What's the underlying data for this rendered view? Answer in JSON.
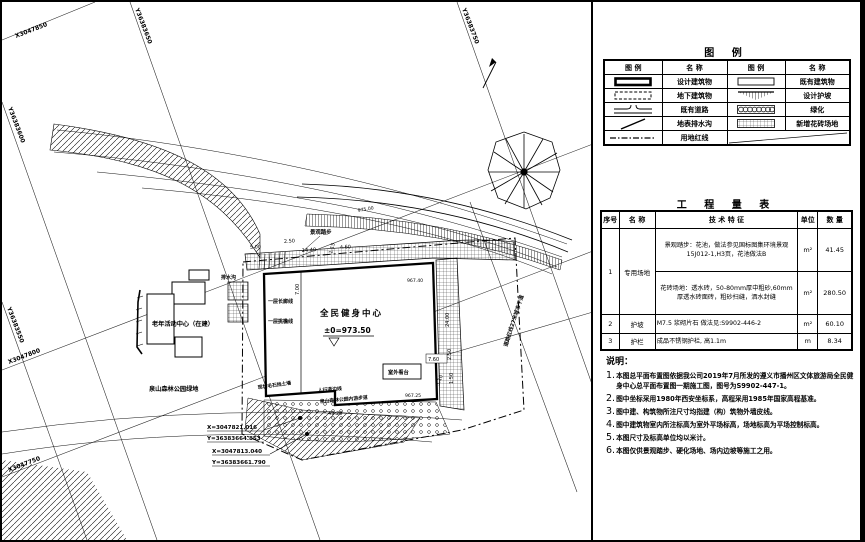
{
  "legend": {
    "title": "图  例",
    "headers": [
      "图  例",
      "名  称",
      "图  例",
      "名  称"
    ],
    "names": {
      "design_building": "设计建筑物",
      "existing_building": "既有建筑物",
      "underground_building": "地下建筑物",
      "design_slope": "设计护坡",
      "existing_road": "既有道路",
      "greenery": "绿化",
      "surface_ditch": "地表排水沟",
      "new_tile_ground": "新增花砖场地",
      "land_red_line": "用地红线"
    }
  },
  "quantity": {
    "title": "工 程 量 表",
    "headers": [
      "序号",
      "名  称",
      "技  术  特  征",
      "单位",
      "数  量"
    ],
    "rows": {
      "r1_no": "1",
      "r1_name": "专用场地",
      "r1a_tech": "景观踏步：花池，做法参见国标图集环境景观 15J012-1,H3页，花池做法B",
      "r1a_unit": "m²",
      "r1a_qty": "41.45",
      "r1b_tech": "花砖场地：透水砖，50-80mm厚中粗砂,60mm 厚透水砖面砖，粗砂扫缝，洒水封缝",
      "r1b_unit": "m²",
      "r1b_qty": "280.50",
      "r2_no": "2",
      "r2_name": "护坡",
      "r2_tech": "M7.5 浆砌片石  做法见:S9902-446-2",
      "r2_unit": "m²",
      "r2_qty": "60.10",
      "r3_no": "3",
      "r3_name": "护栏",
      "r3_tech": "成品不锈钢护栏, 高1.1m",
      "r3_unit": "m",
      "r3_qty": "8.34"
    }
  },
  "notes": {
    "title": "说明：",
    "items": [
      {
        "no": "1.",
        "text": "本图总平面布置图依据我公司2019年7月所发的遵义市播州区文体旅游局全民健身中心总平面布置图一期施工图，图号为S9902-447-1。"
      },
      {
        "no": "2.",
        "text": "图中坐标采用1980年西安坐标系，高程采用1985年国家高程基准。"
      },
      {
        "no": "3.",
        "text": "图中建、构筑物所注尺寸均指建（构）筑物外墙皮线。"
      },
      {
        "no": "4.",
        "text": "图中建筑物室内所注标高为室外平场标高，场地标高为平场控制标高。"
      },
      {
        "no": "5.",
        "text": "本图尺寸及标高单位均以米计。"
      },
      {
        "no": "6.",
        "text": "本图仅供景观踏步、硬化场地、场内边坡等施工之用。"
      }
    ]
  },
  "plan": {
    "building_name": "全民健身中心",
    "building_level": "±0=973.50",
    "senior_center": "老年活动中心（在建）",
    "park_green": "泉山森林公园绿地",
    "park_path": "泉山森林公园内游步道",
    "sidewalk": "人行道边线",
    "retaining_wall": "现状毛石挡土墙",
    "landscape_steps": "景观踏步",
    "corridor_line": "一层长廊线",
    "eave_line": "一层挑檐线",
    "drain": "排水沟",
    "outdoor_stand": "室外看台",
    "road_label": "道路红线27米城市干道",
    "grid": {
      "x1": "X3047850",
      "x2": "X3047800",
      "x3": "X3047750",
      "y1": "Y36383600",
      "y2": "Y36383550",
      "y3": "Y36383650",
      "y4": "Y36383750"
    },
    "coords": {
      "p1x": "X=3047821.016",
      "p1y": "Y=36383664.853",
      "p2x": "X=3047813.040",
      "p2y": "Y=36383661.790"
    },
    "dims": {
      "d500": "5.00",
      "d250": "2.50",
      "d1440": "14.40",
      "d115": "1.15",
      "d460": "4.60",
      "d700": "7.00",
      "d2400": "24.00",
      "d250b": "2.50",
      "d150": "1.50",
      "d510": "5.10",
      "d760": "7.60",
      "d4920": "49.20",
      "e1": "967.40",
      "e2": "967.25",
      "c1": "975.00"
    }
  }
}
